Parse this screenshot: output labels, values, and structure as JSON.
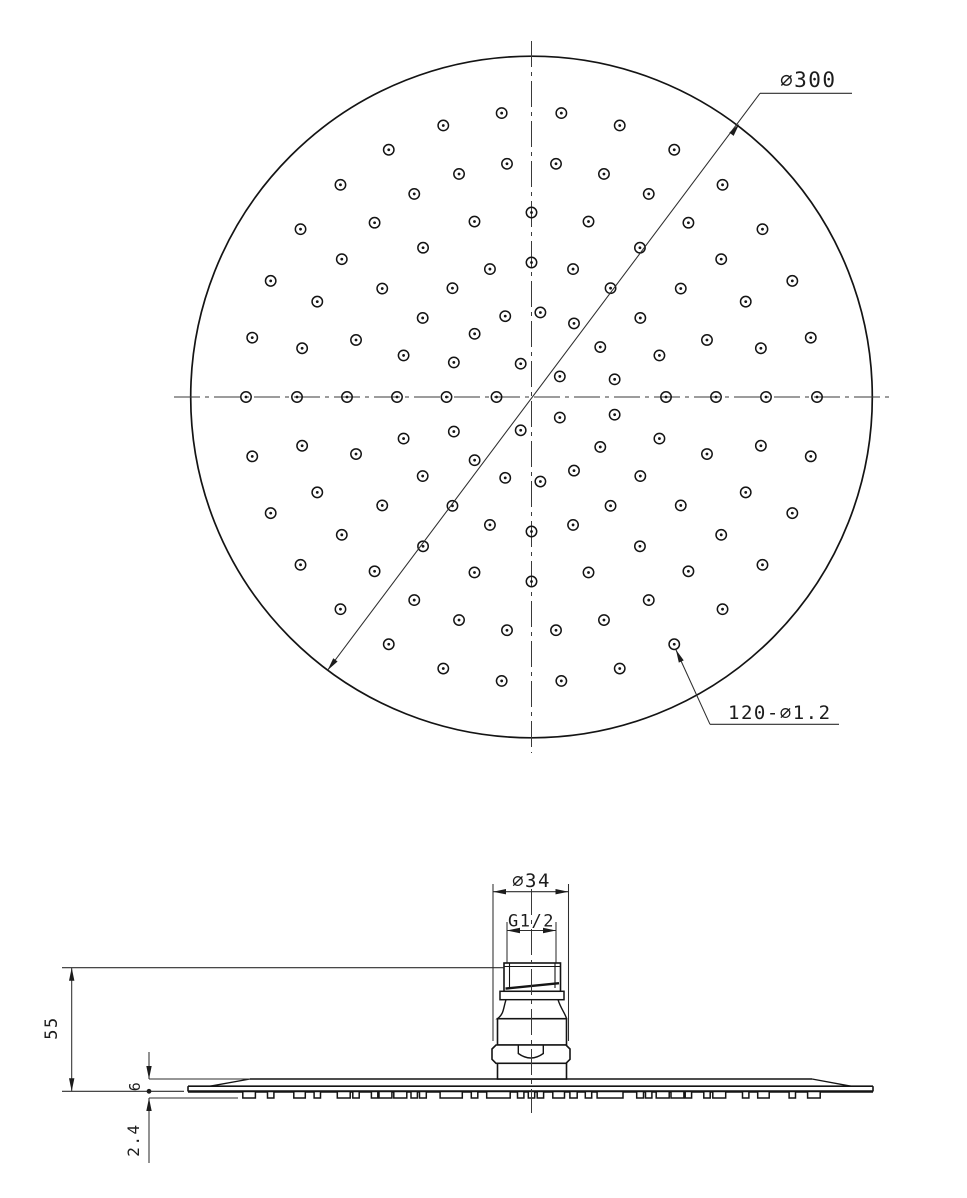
{
  "labels": {
    "overall_diameter": "∅300",
    "holes_note": "120-∅1.2",
    "connector_diameter": "∅34",
    "thread_size": "G1/2",
    "overall_height": "55",
    "plate_thickness": "6",
    "nozzle_height": "2.4"
  },
  "colors": {
    "background": "#ffffff",
    "object_line": "#141414",
    "dimension_line": "#2e2e2e",
    "text": "#1c1c1c"
  },
  "top_view": {
    "cx": 531.5,
    "cy": 397,
    "radius": 340.8,
    "centerline_h": {
      "x1": 174,
      "x2": 889
    },
    "centerline_v": {
      "y1": 41,
      "y2": 753
    },
    "hole_outer_r": 5.2,
    "hole_dot_r": 1.4,
    "hole_rings": [
      {
        "r": 35,
        "count": 5,
        "offset_deg": 36,
        "step_deg": 72
      },
      {
        "r": 85,
        "count": 15,
        "offset_deg": 12,
        "step_deg": 24
      },
      {
        "r": 134.5,
        "count": 20,
        "offset_deg": 0,
        "step_deg": 18
      },
      {
        "r": 184.5,
        "count": 20,
        "offset_deg": 0,
        "step_deg": 18
      },
      {
        "r": 234.5,
        "count": 30,
        "offset_deg": 0,
        "step_deg": 12
      },
      {
        "r": 285.5,
        "count": 30,
        "offset_deg": 0,
        "step_deg": 12
      }
    ],
    "dia_dim": {
      "tip1": {
        "x": 327.6,
        "y": 670.2
      },
      "tip2": {
        "x": 739.3,
        "y": 123.9
      },
      "ext_end": {
        "x": 760,
        "y": 93.3
      },
      "underline_x2": 852,
      "label_x": 780,
      "label_y": 87,
      "font": 21
    },
    "note_dim": {
      "hole": {
        "x": 673.3,
        "y": 644
      },
      "bend": {
        "x": 710,
        "y": 724.3
      },
      "underline_x2": 839,
      "label_x": 728,
      "label_y": 719,
      "font": 19
    }
  },
  "side_view": {
    "cx": 531.5,
    "plate": {
      "left": 188,
      "right": 873,
      "rim_top": 1086.2,
      "flat_top": 1079,
      "bottom": 1091.5,
      "chamfer_l": 210,
      "flat_l": 250,
      "flat_r": 812,
      "chamfer_r": 851
    },
    "nozzles": {
      "bottom": 1098,
      "half_width": 3.2,
      "merge_gap": 7,
      "height_top": 1091.5
    },
    "cap": {
      "x1": 504,
      "x2": 560.5,
      "y1": 963,
      "y2": 991.3,
      "inner_x1": 509.5,
      "inner_x2": 555,
      "inner_y2": 988,
      "top_line_y": 966.5,
      "slant": {
        "x1": 505.5,
        "y1": 988.6,
        "x2": 559,
        "y2": 983.2
      }
    },
    "washer": {
      "x1": 500,
      "x2": 564,
      "y1": 991.3,
      "y2": 999.7
    },
    "bell": {
      "top_x1": 506,
      "top_x2": 558,
      "y1": 999.7,
      "bot_x1": 497.5,
      "bot_x2": 566.5,
      "y2": 1018.7
    },
    "cylinder": {
      "x1": 497.5,
      "x2": 566.5,
      "y1": 1018.7,
      "y2": 1045
    },
    "nut": {
      "x1": 492,
      "x2": 570,
      "y1": 1045,
      "y2": 1063.3,
      "chamfer": 4,
      "flat_x1": 518.3,
      "flat_x2": 543.3,
      "flat_drop": 1053.5,
      "arc_dip": 1062.5
    },
    "base": {
      "x1": 497.5,
      "x2": 566.5,
      "y1": 1063.3,
      "y2": 1079
    },
    "centerline": {
      "x": 531.5,
      "y1": 889,
      "y2": 1113
    }
  },
  "dimensions": {
    "d34": {
      "line_y": 891.7,
      "x1": 493,
      "x2": 568.5,
      "ext_y1": 884,
      "ext_y2": 1041,
      "label_y": 887,
      "font": 19
    },
    "g12": {
      "line_y": 930.5,
      "x1": 507,
      "x2": 556,
      "ext_y1": 922,
      "ext_y2": 962.5,
      "label_y": 926.5,
      "font": 17
    },
    "h55": {
      "x": 71.7,
      "y1": 967.7,
      "y2": 1091.3,
      "ext_x1": 62,
      "ext_top_x2": 503.5,
      "ext_bot_x2": 184,
      "label_x": 57,
      "label_y": 1028,
      "font": 17
    },
    "t6": {
      "x": 149,
      "line_top": 1052,
      "tip_top": 1079,
      "dot_y": 1091.3,
      "dot_r": 2.4,
      "ext_top_x2": 250,
      "ext_bot_y": 1098,
      "ext_bot_x2": 238,
      "label_x": 140,
      "label_y": 1086,
      "font": 15
    },
    "n24": {
      "x": 149,
      "tip": 1098,
      "line_bot": 1163,
      "label_x": 139,
      "label_y": 1140,
      "font": 16
    }
  }
}
